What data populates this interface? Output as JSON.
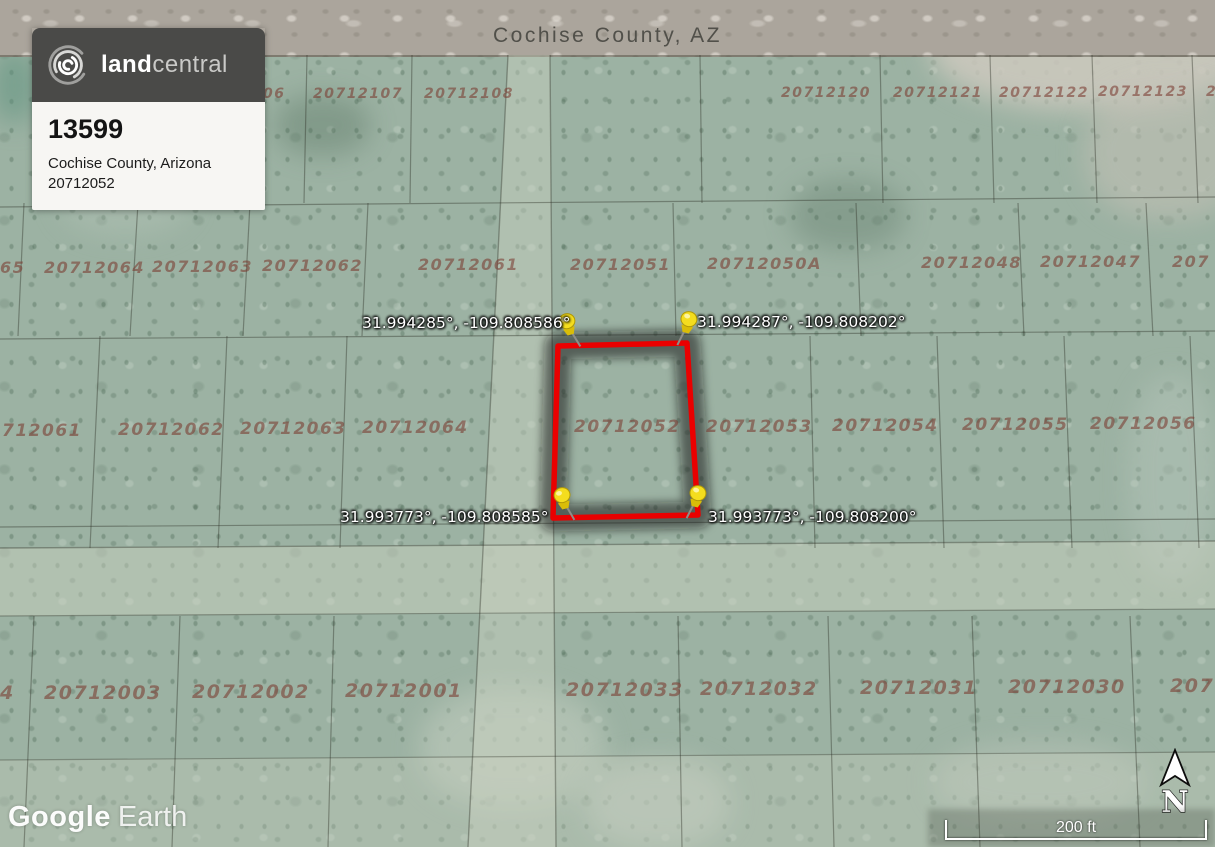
{
  "listing_card": {
    "brand_bold": "land",
    "brand_light": "central",
    "listing_id": "13599",
    "location": "Cochise County, Arizona",
    "parcel_number": "20712052"
  },
  "map": {
    "region_label": "Cochise County, AZ",
    "watermark_part1": "Google",
    "watermark_part2": "Earth",
    "compass_letter": "N",
    "scale_label": "200 ft",
    "highlighted_parcel": "20712052"
  },
  "corner_coordinates": {
    "top_left": "31.994285°, -109.808586°",
    "top_right": "31.994287°, -109.808202°",
    "bottom_left": "31.993773°, -109.808585°",
    "bottom_right": "31.993773°, -109.808200°"
  },
  "colors": {
    "boundary_red": "#ea0000",
    "pin_yellow": "#f4dd1e",
    "pin_yellow_dark": "#d9bd08",
    "terrain_green": "#9cb2a3",
    "road_gray": "#aba59c",
    "parcel_text_maroon": "#7a3a30",
    "card_header_gray": "#4a4a48"
  },
  "parcel_labels": [
    {
      "text": "06",
      "x": 263,
      "y": 86,
      "fs": 14
    },
    {
      "text": "20712107",
      "x": 313,
      "y": 86,
      "fs": 14
    },
    {
      "text": "20712108",
      "x": 424,
      "y": 86,
      "fs": 14
    },
    {
      "text": "20712120",
      "x": 781,
      "y": 85,
      "fs": 14
    },
    {
      "text": "20712121",
      "x": 893,
      "y": 85,
      "fs": 14
    },
    {
      "text": "20712122",
      "x": 999,
      "y": 85,
      "fs": 14
    },
    {
      "text": "20712123",
      "x": 1098,
      "y": 84,
      "fs": 14
    },
    {
      "text": "2",
      "x": 1206,
      "y": 84,
      "fs": 14
    },
    {
      "text": "65",
      "x": 0,
      "y": 258,
      "fs": 16
    },
    {
      "text": "20712064",
      "x": 44,
      "y": 258,
      "fs": 16
    },
    {
      "text": "20712063",
      "x": 152,
      "y": 257,
      "fs": 16
    },
    {
      "text": "20712062",
      "x": 262,
      "y": 256,
      "fs": 16
    },
    {
      "text": "20712061",
      "x": 418,
      "y": 255,
      "fs": 16
    },
    {
      "text": "20712051",
      "x": 570,
      "y": 255,
      "fs": 16
    },
    {
      "text": "20712050A",
      "x": 707,
      "y": 254,
      "fs": 16
    },
    {
      "text": "20712048",
      "x": 921,
      "y": 253,
      "fs": 16
    },
    {
      "text": "20712047",
      "x": 1040,
      "y": 252,
      "fs": 16
    },
    {
      "text": "207",
      "x": 1172,
      "y": 252,
      "fs": 16
    },
    {
      "text": "712061",
      "x": 2,
      "y": 421,
      "fs": 17
    },
    {
      "text": "20712062",
      "x": 118,
      "y": 420,
      "fs": 17
    },
    {
      "text": "20712063",
      "x": 240,
      "y": 419,
      "fs": 17
    },
    {
      "text": "20712064",
      "x": 362,
      "y": 418,
      "fs": 17
    },
    {
      "text": "20712052",
      "x": 574,
      "y": 417,
      "fs": 17
    },
    {
      "text": "20712053",
      "x": 706,
      "y": 417,
      "fs": 17
    },
    {
      "text": "20712054",
      "x": 832,
      "y": 416,
      "fs": 17
    },
    {
      "text": "20712055",
      "x": 962,
      "y": 415,
      "fs": 17
    },
    {
      "text": "20712056",
      "x": 1090,
      "y": 414,
      "fs": 17
    },
    {
      "text": "4",
      "x": 0,
      "y": 682,
      "fs": 19
    },
    {
      "text": "20712003",
      "x": 44,
      "y": 682,
      "fs": 19
    },
    {
      "text": "20712002",
      "x": 192,
      "y": 681,
      "fs": 19
    },
    {
      "text": "20712001",
      "x": 345,
      "y": 680,
      "fs": 19
    },
    {
      "text": "20712033",
      "x": 566,
      "y": 679,
      "fs": 19
    },
    {
      "text": "20712032",
      "x": 700,
      "y": 678,
      "fs": 19
    },
    {
      "text": "20712031",
      "x": 860,
      "y": 677,
      "fs": 19
    },
    {
      "text": "20712030",
      "x": 1008,
      "y": 676,
      "fs": 19
    },
    {
      "text": "207",
      "x": 1170,
      "y": 675,
      "fs": 19
    }
  ]
}
